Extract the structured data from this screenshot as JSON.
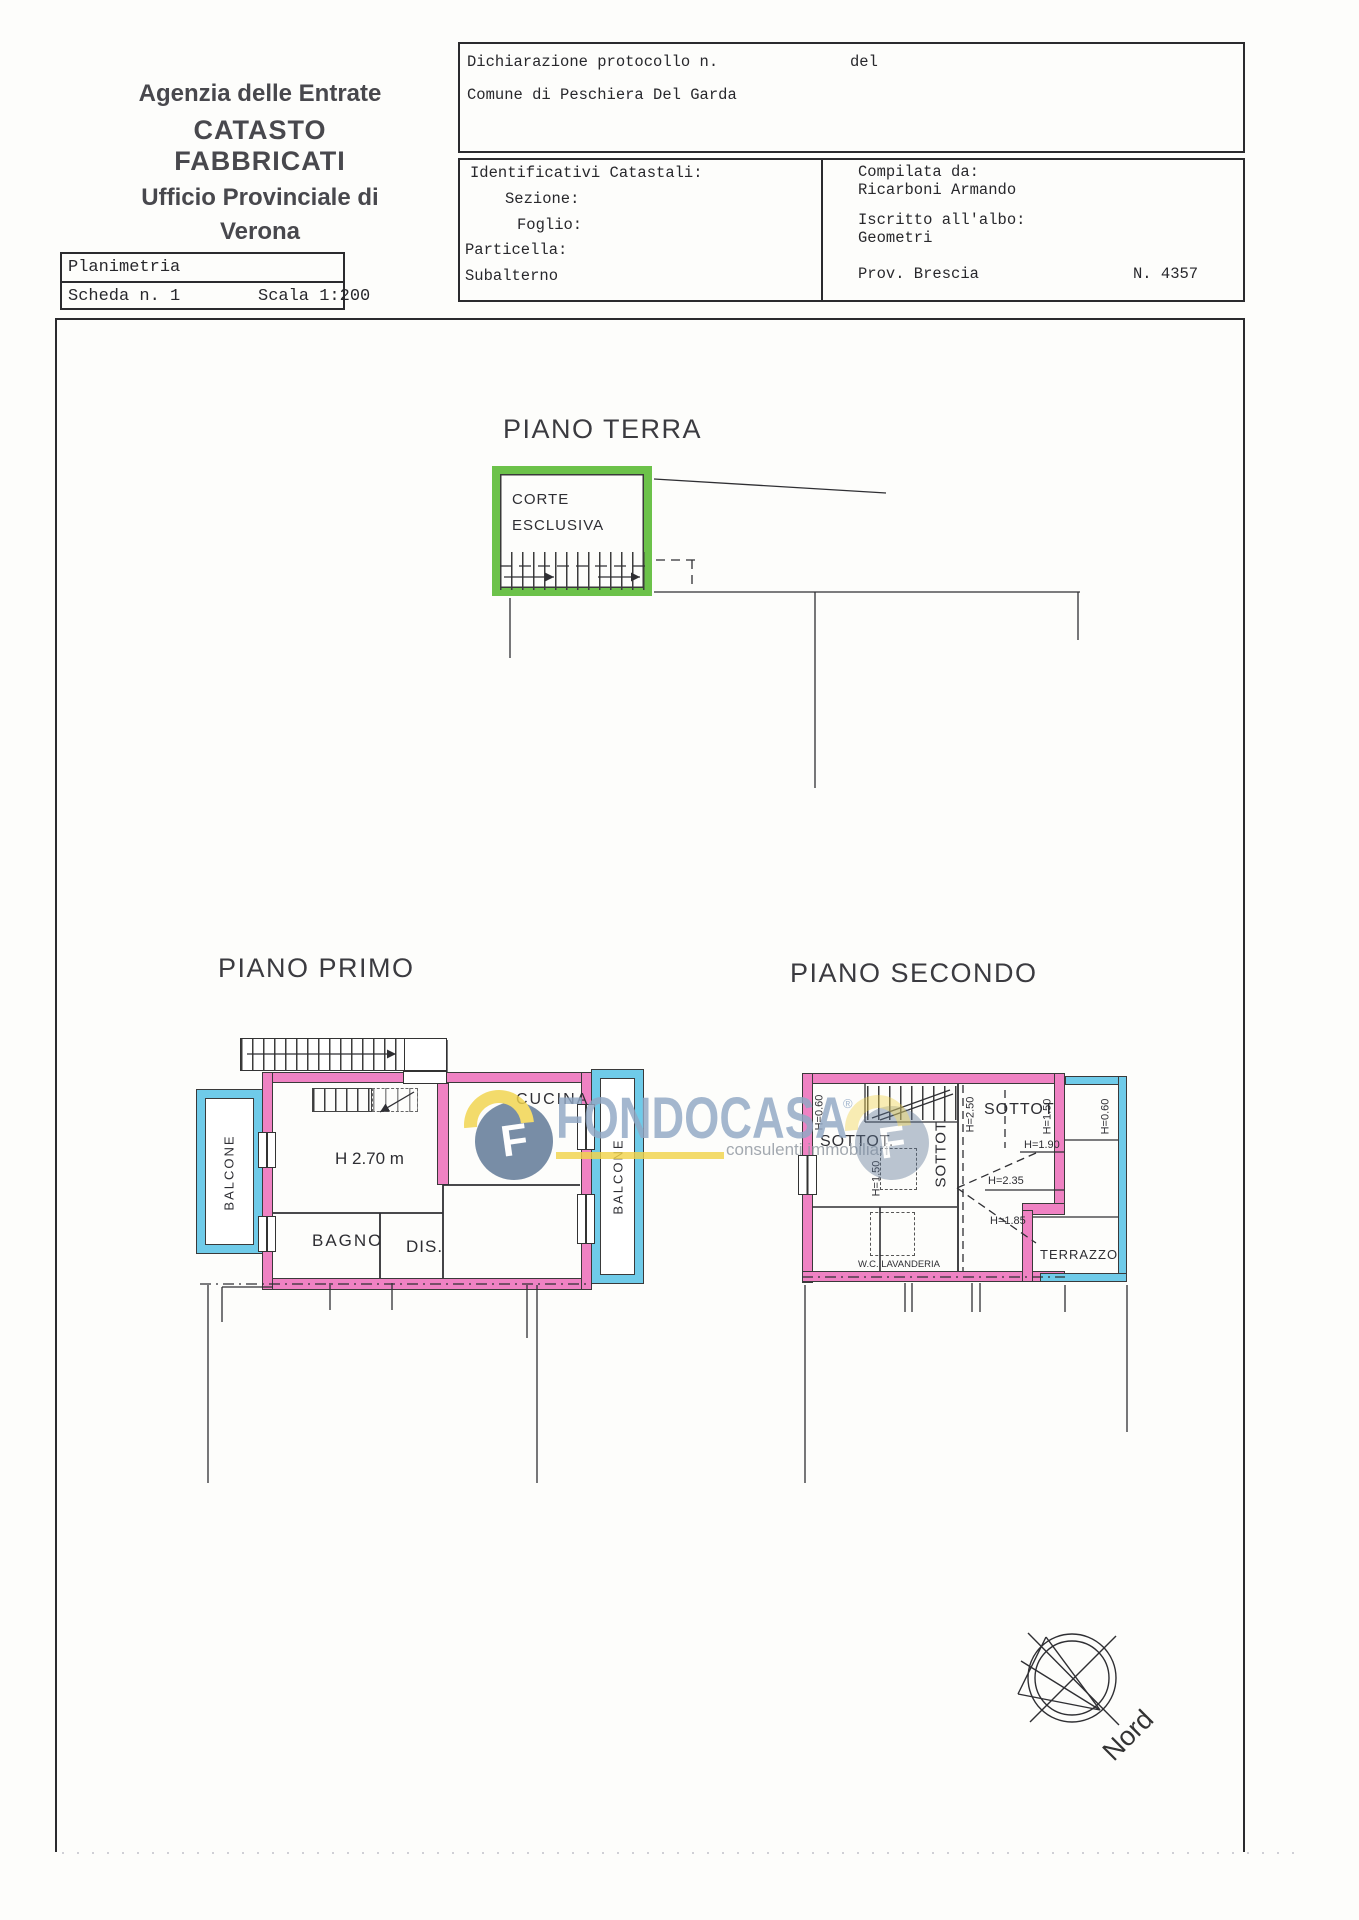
{
  "colors": {
    "wall_pink": "#ef82c3",
    "court_green": "#6cc24a",
    "balcony_blue": "#6fcbe9",
    "watermark_blue": "#91a8c5",
    "watermark_yellow": "#f2d44c",
    "line": "#333333"
  },
  "header": {
    "line1": "Agenzia delle Entrate",
    "line2": "CATASTO FABBRICATI",
    "line3": "Ufficio Provinciale di",
    "line4": "Verona"
  },
  "scheda": {
    "title": "Planimetria",
    "sheet": "Scheda n. 1",
    "scale": "Scala 1:200"
  },
  "declaration": {
    "protocol": "Dichiarazione protocollo n.",
    "del": "del",
    "comune": "Comune di Peschiera Del Garda"
  },
  "cadastral": {
    "title": "Identificativi Catastali:",
    "sezione": "Sezione:",
    "foglio": "Foglio:",
    "particella": "Particella:",
    "subalterno": "Subalterno"
  },
  "compiler": {
    "label": "Compilata da:",
    "name": "Ricarboni Armando",
    "albo_label": "Iscritto all'albo:",
    "albo": "Geometri",
    "prov": "Prov. Brescia",
    "number": "N. 4357"
  },
  "floors": {
    "terra": {
      "title": "PIANO TERRA",
      "corte1": "CORTE",
      "corte2": "ESCLUSIVA"
    },
    "primo": {
      "title": "PIANO PRIMO",
      "balcone_sx": "BALCONE",
      "balcone_dx": "BALCONE",
      "cucina": "CUCINA",
      "altezza": "H 2.70 m",
      "bagno": "BAGNO",
      "dis": "DIS."
    },
    "secondo": {
      "title": "PIANO SECONDO",
      "sottotetto_sx": "SOTTOT.",
      "sottotetto_c": "SOTTOT.",
      "sottotetto_dx": "SOTTOT",
      "h_060_sx": "H=0.60",
      "h_150_sx": "H=1.50",
      "h_250": "H=2.50",
      "h_150_dx": "H=1.50",
      "h_190": "H=1.90",
      "h_235": "H=2.35",
      "h_185": "H=1.85",
      "h_060_dx": "H=0.60",
      "terrazzo": "TERRAZZO",
      "wc": "W.C. LAVANDERIA"
    }
  },
  "watermark": {
    "brand": "FONDOCASA",
    "registered": "®",
    "tagline": "consulenti immobiliari"
  },
  "compass": {
    "label": "Nord"
  }
}
